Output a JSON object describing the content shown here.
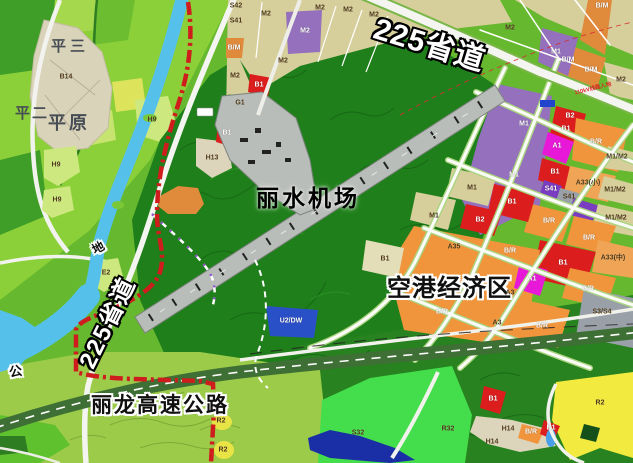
{
  "map": {
    "titles": {
      "road_225_top": "225省道",
      "road_225_left": "225省道",
      "airport": "丽水机场",
      "econ_zone": "空港经济区",
      "expressway": "丽龙高速公路",
      "char_di": "地",
      "char_gong": "公",
      "village_pingsan": "平三",
      "village_pinger": "平二",
      "village_pingyuan": "平原",
      "annotation_110kv": "110kV线路入地"
    },
    "zone_colors": {
      "M2": "#d6cf9c",
      "M1": "#9470bd",
      "BM": "#e08a3c",
      "BR": "#f0953c",
      "B": "#dc1d1d",
      "A": "#e818d8",
      "A33": "#f0a455",
      "S41": "#7a3cc0",
      "SG": "#9aa0a8",
      "R2": "#f2ea3e",
      "H": "#ddd5bb",
      "H9": "#cde87e",
      "U2": "#2a50c8",
      "S32": "#44dd4b",
      "G1": "#7cc437",
      "river": "#55c0ea",
      "lake": "#1a2fa5",
      "pond": "#4aa0e8",
      "hills_dark": "#1f7f1b",
      "hills_low": "#27821f",
      "hills_light": "#9ccb49",
      "fields": "#8bd038",
      "village": "#d9d3b9",
      "runway": "#b9bdb9",
      "boundary_red": "#cf1d1d",
      "expressway": "#3e6f35",
      "road_white": "#f4f4f0",
      "road_verge": "#aad47f",
      "powerline_red": "#d23030",
      "chip_blue": "#2244cc"
    },
    "parcel_labels": [
      {
        "t": "S42",
        "x": 236,
        "y": 6,
        "c": "d"
      },
      {
        "t": "S41",
        "x": 236,
        "y": 21,
        "c": "d"
      },
      {
        "t": "B/M",
        "x": 234,
        "y": 48,
        "c": "w"
      },
      {
        "t": "M2",
        "x": 235,
        "y": 76,
        "c": "d"
      },
      {
        "t": "B1",
        "x": 259,
        "y": 85,
        "c": "w"
      },
      {
        "t": "G1",
        "x": 240,
        "y": 103,
        "c": "d"
      },
      {
        "t": "M2",
        "x": 266,
        "y": 14,
        "c": "d"
      },
      {
        "t": "M2",
        "x": 305,
        "y": 31,
        "c": "w"
      },
      {
        "t": "M2",
        "x": 283,
        "y": 61,
        "c": "d"
      },
      {
        "t": "M2",
        "x": 320,
        "y": 8,
        "c": "d"
      },
      {
        "t": "M2",
        "x": 348,
        "y": 10,
        "c": "d"
      },
      {
        "t": "M2",
        "x": 374,
        "y": 15,
        "c": "d"
      },
      {
        "t": "M2",
        "x": 510,
        "y": 28,
        "c": "d"
      },
      {
        "t": "B/M",
        "x": 602,
        "y": 6,
        "c": "w"
      },
      {
        "t": "B/M",
        "x": 568,
        "y": 60,
        "c": "w"
      },
      {
        "t": "B/M",
        "x": 591,
        "y": 70,
        "c": "w"
      },
      {
        "t": "M2",
        "x": 621,
        "y": 80,
        "c": "d"
      },
      {
        "t": "M1",
        "x": 556,
        "y": 52,
        "c": "w"
      },
      {
        "t": "M1",
        "x": 524,
        "y": 124,
        "c": "w"
      },
      {
        "t": "M1",
        "x": 514,
        "y": 175,
        "c": "w"
      },
      {
        "t": "B2",
        "x": 570,
        "y": 116,
        "c": "w"
      },
      {
        "t": "B1",
        "x": 566,
        "y": 129,
        "c": "w"
      },
      {
        "t": "A1",
        "x": 557,
        "y": 146,
        "c": "w"
      },
      {
        "t": "B/R",
        "x": 596,
        "y": 142,
        "c": "w"
      },
      {
        "t": "M1/M2",
        "x": 617,
        "y": 157,
        "c": "d"
      },
      {
        "t": "B1",
        "x": 555,
        "y": 172,
        "c": "w"
      },
      {
        "t": "A33(小)",
        "x": 588,
        "y": 183,
        "c": "d"
      },
      {
        "t": "S41",
        "x": 551,
        "y": 189,
        "c": "w"
      },
      {
        "t": "S41",
        "x": 569,
        "y": 197,
        "c": "d"
      },
      {
        "t": "M1/M2",
        "x": 615,
        "y": 190,
        "c": "d"
      },
      {
        "t": "M1/M2",
        "x": 616,
        "y": 218,
        "c": "d"
      },
      {
        "t": "B/R",
        "x": 549,
        "y": 221,
        "c": "w"
      },
      {
        "t": "B/R",
        "x": 589,
        "y": 238,
        "c": "w"
      },
      {
        "t": "B1",
        "x": 563,
        "y": 263,
        "c": "w"
      },
      {
        "t": "A33(中)",
        "x": 613,
        "y": 258,
        "c": "d"
      },
      {
        "t": "B/R",
        "x": 588,
        "y": 289,
        "c": "w"
      },
      {
        "t": "S3/S4",
        "x": 602,
        "y": 312,
        "c": "d"
      },
      {
        "t": "B/R",
        "x": 542,
        "y": 326,
        "c": "w"
      },
      {
        "t": "M1",
        "x": 472,
        "y": 188,
        "c": "d"
      },
      {
        "t": "M1",
        "x": 434,
        "y": 216,
        "c": "d"
      },
      {
        "t": "B2",
        "x": 480,
        "y": 220,
        "c": "w"
      },
      {
        "t": "B1",
        "x": 512,
        "y": 202,
        "c": "w"
      },
      {
        "t": "B1",
        "x": 385,
        "y": 259,
        "c": "d"
      },
      {
        "t": "A35",
        "x": 454,
        "y": 247,
        "c": "d"
      },
      {
        "t": "B/R",
        "x": 510,
        "y": 251,
        "c": "w"
      },
      {
        "t": "A1",
        "x": 532,
        "y": 279,
        "c": "w"
      },
      {
        "t": "A3",
        "x": 510,
        "y": 293,
        "c": "d"
      },
      {
        "t": "B/R",
        "x": 442,
        "y": 312,
        "c": "w"
      },
      {
        "t": "A3",
        "x": 497,
        "y": 323,
        "c": "d"
      },
      {
        "t": "U2/DW",
        "x": 291,
        "y": 321,
        "c": "w"
      },
      {
        "t": "R2",
        "x": 600,
        "y": 403,
        "c": "d"
      },
      {
        "t": "H14",
        "x": 508,
        "y": 429,
        "c": "d"
      },
      {
        "t": "B/R",
        "x": 531,
        "y": 432,
        "c": "w"
      },
      {
        "t": "B1",
        "x": 551,
        "y": 428,
        "c": "w"
      },
      {
        "t": "H14",
        "x": 492,
        "y": 442,
        "c": "d"
      },
      {
        "t": "S32",
        "x": 358,
        "y": 433,
        "c": "d"
      },
      {
        "t": "R32",
        "x": 448,
        "y": 429,
        "c": "d"
      },
      {
        "t": "B1",
        "x": 493,
        "y": 399,
        "c": "w"
      },
      {
        "t": "R2",
        "x": 221,
        "y": 421,
        "c": "d"
      },
      {
        "t": "R2",
        "x": 223,
        "y": 450,
        "c": "d"
      },
      {
        "t": "E2",
        "x": 106,
        "y": 273,
        "c": "d"
      },
      {
        "t": "H13",
        "x": 212,
        "y": 158,
        "c": "d"
      },
      {
        "t": "B1",
        "x": 227,
        "y": 133,
        "c": "w"
      },
      {
        "t": "H9",
        "x": 152,
        "y": 120,
        "c": "d"
      },
      {
        "t": "H9",
        "x": 56,
        "y": 165,
        "c": "d"
      },
      {
        "t": "H9",
        "x": 57,
        "y": 200,
        "c": "d"
      },
      {
        "t": "B14",
        "x": 66,
        "y": 77,
        "c": "d"
      }
    ]
  }
}
